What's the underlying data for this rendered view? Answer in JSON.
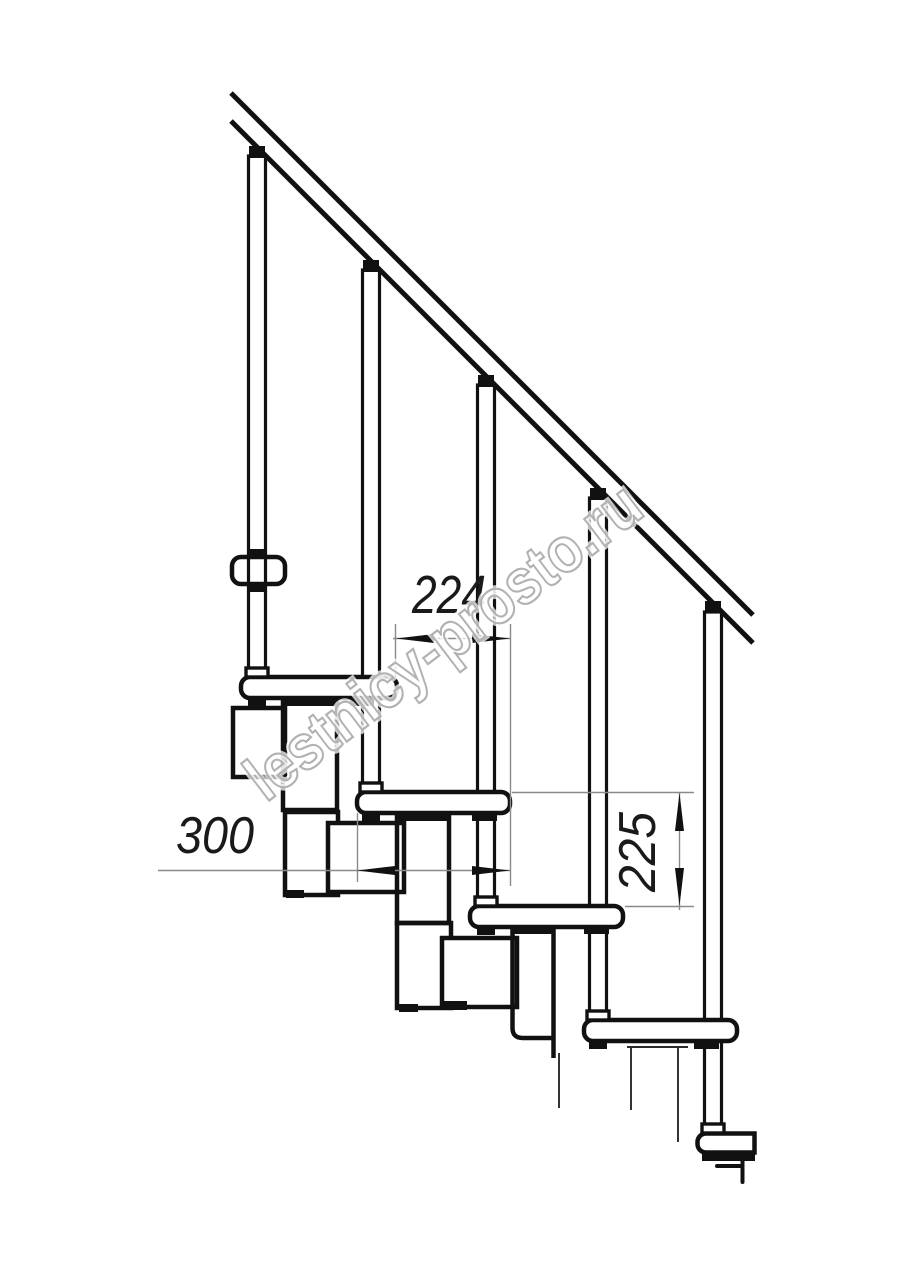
{
  "drawing": {
    "title_hint": "modular staircase side elevation",
    "watermark": {
      "text": "lestnicy-prosto.ru"
    },
    "dimensions": {
      "tread_run": {
        "value": "224"
      },
      "tread_depth": {
        "value": "300"
      },
      "step_rise": {
        "value": "225"
      }
    },
    "colors": {
      "line": "#111111",
      "dim_line": "#8a8a8a",
      "dim_text": "#1a1a1a",
      "watermark_stroke": "#b2b2b2",
      "background": "#ffffff"
    }
  }
}
